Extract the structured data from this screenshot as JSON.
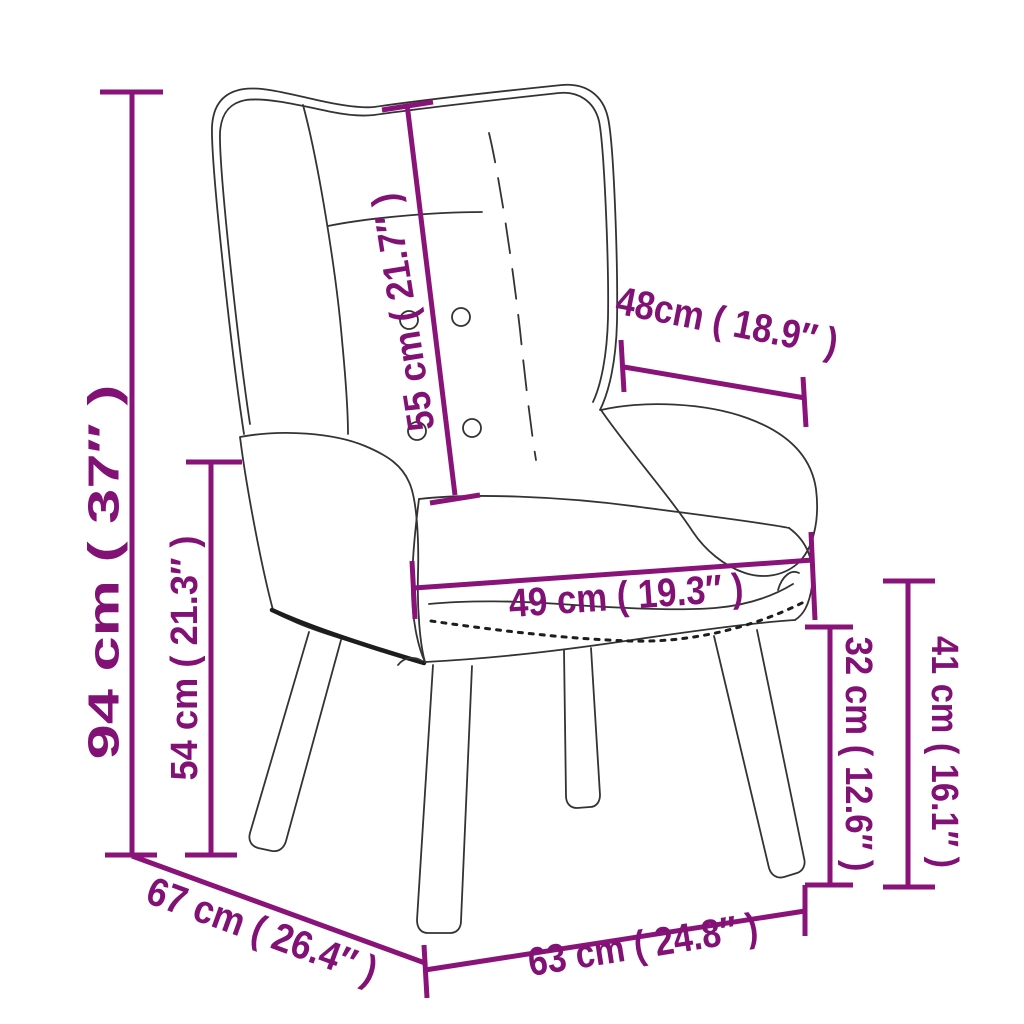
{
  "diagram": {
    "subject": "wingback-chair-dimension-drawing",
    "accent_color": "#8a1379",
    "outline_color": "#333333",
    "dimensions": {
      "total_height": {
        "label": "94 cm ( 37″ )"
      },
      "seat_side_height": {
        "label": "54 cm ( 21.3″ )"
      },
      "backrest_length": {
        "label": "55 cm ( 21.7″ )"
      },
      "armrest_depth": {
        "label": "48cm ( 18.9″ )"
      },
      "seat_width": {
        "label": "49 cm ( 19.3″ )"
      },
      "clearance_height": {
        "label": "32 cm ( 12.6″ )"
      },
      "seat_top_height": {
        "label": "41 cm ( 16.1″ )"
      },
      "total_depth": {
        "label": "67 cm ( 26.4″ )"
      },
      "base_width": {
        "label": "63 cm ( 24.8″ )"
      }
    }
  }
}
